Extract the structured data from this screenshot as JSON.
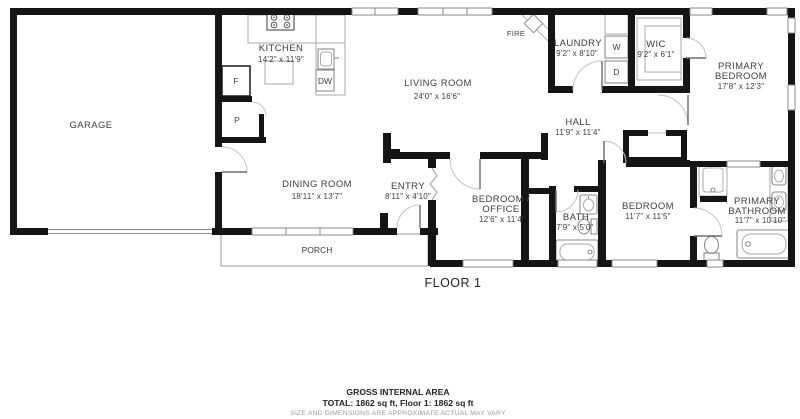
{
  "colors": {
    "wall": "#151515",
    "fixture": "#a9a9a9",
    "label_text": "#3d3d3d",
    "muted_text": "#9a9a9a"
  },
  "floor": {
    "label": "FLOOR 1"
  },
  "rooms": {
    "garage": {
      "name": "GARAGE"
    },
    "kitchen": {
      "name": "KITCHEN",
      "dims": "14'2\" x 11'9\""
    },
    "living_room": {
      "name": "LIVING ROOM",
      "dims": "24'0\" x 16'6\""
    },
    "dining_room": {
      "name": "DINING ROOM",
      "dims": "18'11\" x 13'7\""
    },
    "entry": {
      "name": "ENTRY",
      "dims": "8'11\" x 4'10\""
    },
    "laundry": {
      "name": "LAUNDRY",
      "dims": "9'2\" x 8'10\""
    },
    "wic": {
      "name": "WIC",
      "dims": "9'2\" x 6'1\""
    },
    "primary_bedroom": {
      "name_line1": "PRIMARY",
      "name_line2": "BEDROOM",
      "dims": "17'8\" x 12'3\""
    },
    "hall": {
      "name": "HALL",
      "dims": "11'9\" x 11'4\""
    },
    "bedroom_office": {
      "name_line1": "BEDROOM /",
      "name_line2": "OFFICE",
      "dims": "12'6\" x 11'4\""
    },
    "bath": {
      "name": "BATH",
      "dims": "7'9\" x 5'0\""
    },
    "bedroom": {
      "name": "BEDROOM",
      "dims": "11'7\" x 11'5\""
    },
    "primary_bathroom": {
      "name_line1": "PRIMARY",
      "name_line2": "BATHROOM",
      "dims": "11'7\" x 10'10\""
    },
    "porch": {
      "name": "PORCH"
    }
  },
  "markers": {
    "fireplace": "FIRE",
    "washer": "W",
    "dryer": "D",
    "fridge": "F",
    "pantry": "P",
    "dishwasher": "DW"
  },
  "footer": {
    "area_title": "GROSS INTERNAL AREA",
    "area_total": "TOTAL: 1862 sq ft, Floor 1: 1862 sq ft",
    "disclaimer": "SIZE AND DIMENSIONS ARE APPROXIMATE ACTUAL MAY VARY"
  }
}
